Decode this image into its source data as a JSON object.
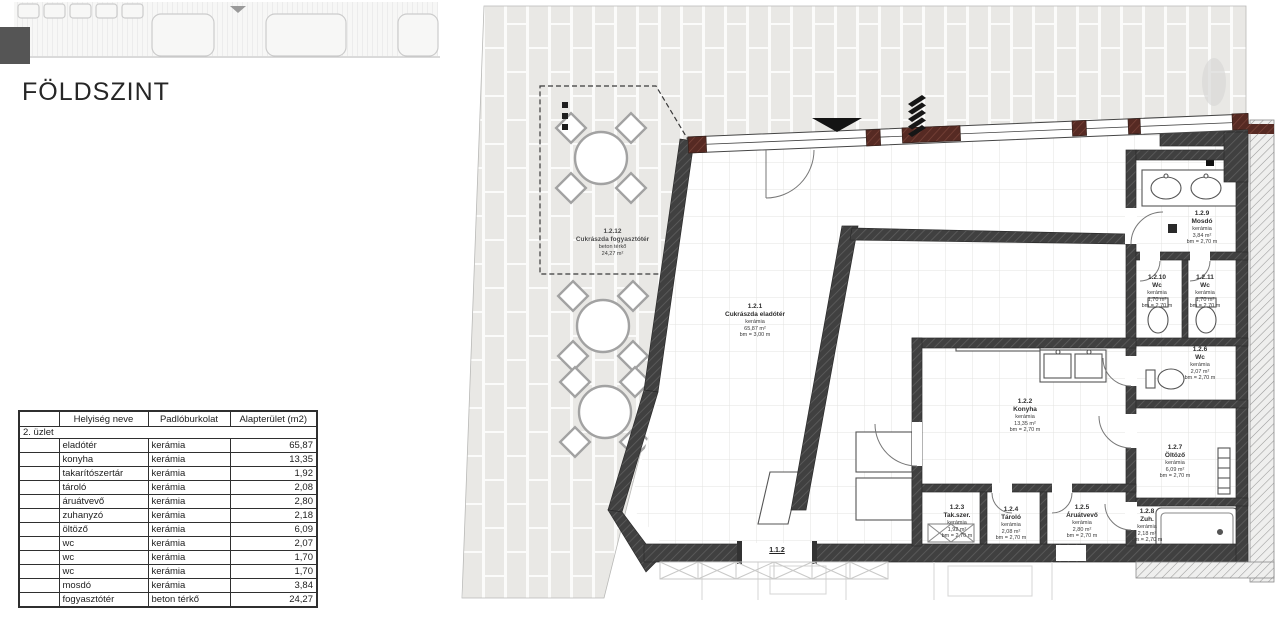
{
  "page": {
    "title": "FÖLDSZINT"
  },
  "table": {
    "headers": [
      "",
      "Helyiség neve",
      "Padlóburkolat",
      "Alapterület (m2)"
    ],
    "group": "2. üzlet",
    "rows": [
      {
        "name": "eladótér",
        "floor": "kerámia",
        "area": "65,87"
      },
      {
        "name": "konyha",
        "floor": "kerámia",
        "area": "13,35"
      },
      {
        "name": "takarítószertár",
        "floor": "kerámia",
        "area": "1,92"
      },
      {
        "name": "tároló",
        "floor": "kerámia",
        "area": "2,08"
      },
      {
        "name": "áruátvevő",
        "floor": "kerámia",
        "area": "2,80"
      },
      {
        "name": "zuhanyzó",
        "floor": "kerámia",
        "area": "2,18"
      },
      {
        "name": "öltöző",
        "floor": "kerámia",
        "area": "6,09"
      },
      {
        "name": "wc",
        "floor": "kerámia",
        "area": "2,07"
      },
      {
        "name": "wc",
        "floor": "kerámia",
        "area": "1,70"
      },
      {
        "name": "wc",
        "floor": "kerámia",
        "area": "1,70"
      },
      {
        "name": "mosdó",
        "floor": "kerámia",
        "area": "3,84"
      },
      {
        "name": "fogyasztótér",
        "floor": "beton térkő",
        "area": "24,27"
      }
    ]
  },
  "plan": {
    "rooms": [
      {
        "id": "1.2.1",
        "name": "Cukrászda eladótér",
        "floor": "kerámia",
        "area": "65,87 m²",
        "height": "bm = 3,00 m"
      },
      {
        "id": "1.2.2",
        "name": "Konyha",
        "floor": "kerámia",
        "area": "13,35 m²",
        "height": "bm = 2,70 m"
      },
      {
        "id": "1.2.3",
        "name": "Tak.szer.",
        "floor": "kerámia",
        "area": "1,92 m²",
        "height": "bm = 2,70 m"
      },
      {
        "id": "1.2.4",
        "name": "Tároló",
        "floor": "kerámia",
        "area": "2,08 m²",
        "height": "bm = 2,70 m"
      },
      {
        "id": "1.2.5",
        "name": "Áruátvevő",
        "floor": "kerámia",
        "area": "2,80 m²",
        "height": "bm = 2,70 m"
      },
      {
        "id": "1.2.6",
        "name": "Wc",
        "floor": "kerámia",
        "area": "2,07 m²",
        "height": "bm = 2,70 m"
      },
      {
        "id": "1.2.7",
        "name": "Öltöző",
        "floor": "kerámia",
        "area": "6,09 m²",
        "height": "bm = 2,70 m"
      },
      {
        "id": "1.2.8",
        "name": "Zuh.",
        "floor": "kerámia",
        "area": "2,18 m²",
        "height": "bm = 2,70 m"
      },
      {
        "id": "1.2.9",
        "name": "Mosdó",
        "floor": "kerámia",
        "area": "3,84 m²",
        "height": "bm = 2,70 m"
      },
      {
        "id": "1.2.10",
        "name": "Wc",
        "floor": "kerámia",
        "area": "1,70 m²",
        "height": "bm = 2,70 m"
      },
      {
        "id": "1.2.11",
        "name": "Wc",
        "floor": "kerámia",
        "area": "1,70 m²",
        "height": "bm = 2,70 m"
      },
      {
        "id": "1.2.12",
        "name": "Cukrászda fogyasztótér",
        "floor": "beton térkő",
        "area": "24,27 m²"
      }
    ],
    "adjacent_unit_label": "1.1.2",
    "colors": {
      "wall_dark": "#404040",
      "brick_red": "#562a23",
      "paving_tile": "#e9e8e5",
      "neighbor_hatch": "#999999"
    }
  }
}
